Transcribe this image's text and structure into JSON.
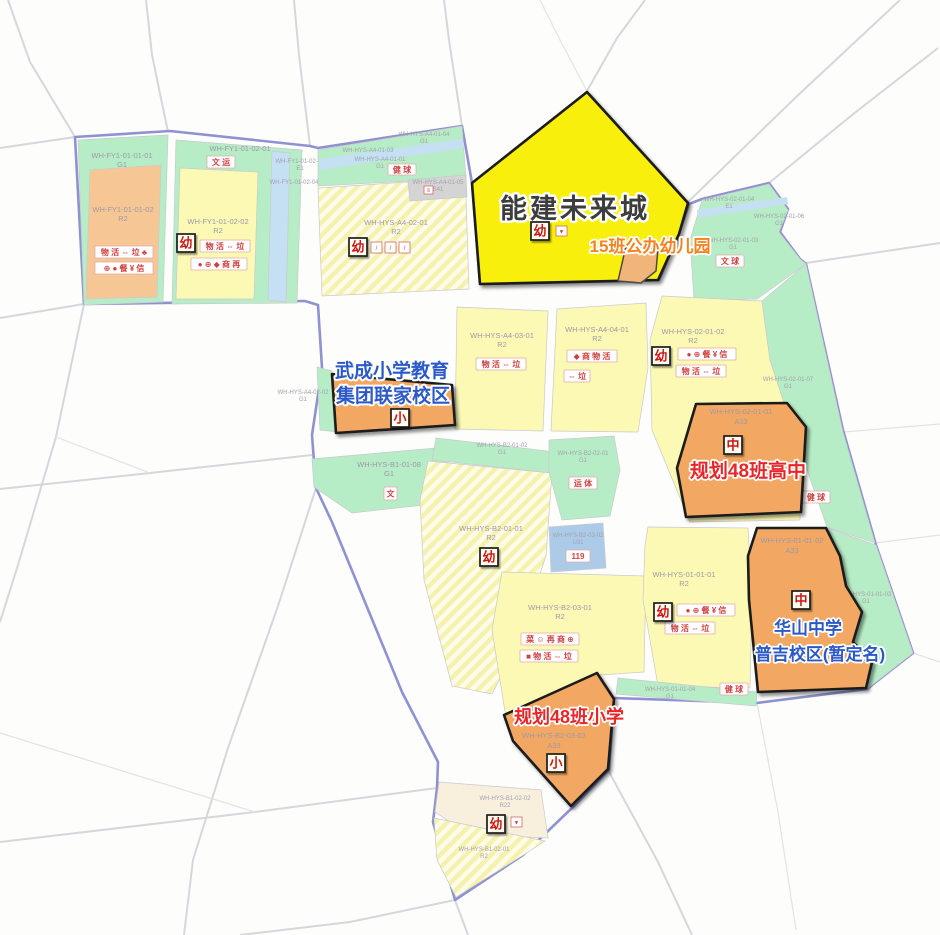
{
  "annotations": {
    "nengjian": "能建未来城",
    "kg15": "15班公办幼儿园",
    "wucheng_l1": "武成小学教育",
    "wucheng_l2": "集团联家校区",
    "highschool": "规划48班高中",
    "huashan_l1": "华山中学",
    "huashan_l2": "普吉校区(暂定名)",
    "primary48": "规划48班小学"
  },
  "badge_glyphs": {
    "kindergarten": "幼",
    "primary": "小",
    "middle": "中",
    "fire": "119",
    "culture": "文"
  },
  "colors": {
    "green": "#b7edc6",
    "yellow": "#fbf9b4",
    "orange_light": "#f6c795",
    "school_orange": "#f2a863",
    "highlight_yellow": "#f8ef0b",
    "water_blue": "#c4e0f2",
    "utility_blue": "#abcbe9",
    "cream": "#f8f0dd",
    "gray_strip": "#d4d4d4",
    "boundary_purple": "#8e92d0",
    "label_red": "#e8262a",
    "label_blue": "#2b59c8",
    "label_orange": "#f58220"
  },
  "parcels": {
    "fy1_0101_01": {
      "code": "WH-FY1-01-01-01",
      "use": "G1"
    },
    "fy1_0101_02": {
      "code": "WH-FY1-01-01-02",
      "use": "R2",
      "icons1": "物 活 ⇔ 垃 ♣",
      "icons2": "⊕ ● 餐 ¥ 信"
    },
    "fy1_0102_01": {
      "code": "WH-FY1-01-02-01",
      "use": "G1",
      "pair": "文 运"
    },
    "fy1_0102_02": {
      "code": "WH-FY1-01-02-02",
      "use": "R2",
      "icons1": "物 活 ⇔ 垃",
      "icons2": "● ⊕ ◆ 商 再"
    },
    "fy1_0102_03": {
      "code": "WH-FY1-01-02-03",
      "use": "E1"
    },
    "fy1_0102_04": {
      "code": "WH-FY1-01-02-04"
    },
    "a4_0104": {
      "code": "WH-HYS-A4-01-04",
      "use": "G1"
    },
    "a4_0103": {
      "code": "WH-HYS-A4-01-03",
      "use": "E1"
    },
    "a4_0101": {
      "code": "WH-HYS-A4-01-01",
      "use": "G1",
      "pair": "健 球"
    },
    "a4_0105": {
      "code": "WH-HYS-A4-01-05",
      "use": "S41"
    },
    "a4_0201": {
      "code": "WH-HYS-A4-02-01",
      "use": "R2"
    },
    "a4_0202": {
      "code": "WH-HYS-A4-02-02",
      "use": "G1"
    },
    "a4_0301": {
      "code": "WH-HYS-A4-03-01",
      "use": "R2",
      "icons1": "物 活 ⇔ 垃"
    },
    "a4_0401": {
      "code": "WH-HYS-A4-04-01",
      "use": "R2",
      "icons1": "◆ 商 物 活",
      "icons2": "⇔ 垃"
    },
    "hys02_0104": {
      "code": "WH-HYS-02-01-04",
      "use": "E1"
    },
    "hys02_0106": {
      "code": "WH-HYS-02-01-06",
      "use": "G1"
    },
    "hys02_0103": {
      "code": "WH-HYS-02-01-03",
      "use": "G1",
      "pair": "文 球"
    },
    "hys02_0102": {
      "code": "WH-HYS-02-01-02",
      "use": "R2",
      "icons1": "● ⊕ 餐 ¥ 信",
      "icons2": "物 活 ⇔ 垃"
    },
    "hys02_0107": {
      "code": "WH-HYS-02-01-07",
      "use": "G1",
      "pair": "健 球"
    },
    "hys02_0101": {
      "code": "WH-HYS-02-01-01",
      "use": "A33"
    },
    "b1_0108": {
      "code": "WH-HYS-B1-01-08",
      "use": "G1",
      "pair": "文"
    },
    "b2_0102": {
      "code": "WH-HYS-B2-01-02",
      "use": "G1"
    },
    "b2_0101": {
      "code": "WH-HYS-B2-01-01",
      "use": "R2"
    },
    "b2_0201": {
      "code": "WH-HYS-B2-02-01",
      "use": "G1",
      "pair": "运 体"
    },
    "b2_0302": {
      "code": "WH-HYS-B2-03-02",
      "use": "U31",
      "pair": "119"
    },
    "b2_0301": {
      "code": "WH-HYS-B2-03-01",
      "use": "R2",
      "icons1": "菜 ☺ 再 商 ⊕",
      "icons2": "■ 物 活 ⇔ 垃"
    },
    "hys01_0101": {
      "code": "WH-HYS-01-01-01",
      "use": "R2",
      "icons1": "● ⊕ 餐 ¥ 信",
      "icons2": "物 活 ⇔ 垃"
    },
    "hys01_0102": {
      "code": "WH-HYS-01-01-02",
      "use": "A33"
    },
    "hys01_0103": {
      "code": "WH-HYS-01-01-03",
      "use": "G1"
    },
    "hys01_0104": {
      "code": "WH-HYS-01-01-04",
      "use": "G1",
      "pair": "健 球"
    },
    "b2_0303": {
      "code": "WH-HYS-B2-03-03",
      "use": "A33"
    },
    "b1_0202": {
      "code": "WH-HYS-B1-02-02",
      "use": "R22"
    },
    "b1_0201": {
      "code": "WH-HYS-B1-02-01",
      "use": "R2"
    }
  }
}
